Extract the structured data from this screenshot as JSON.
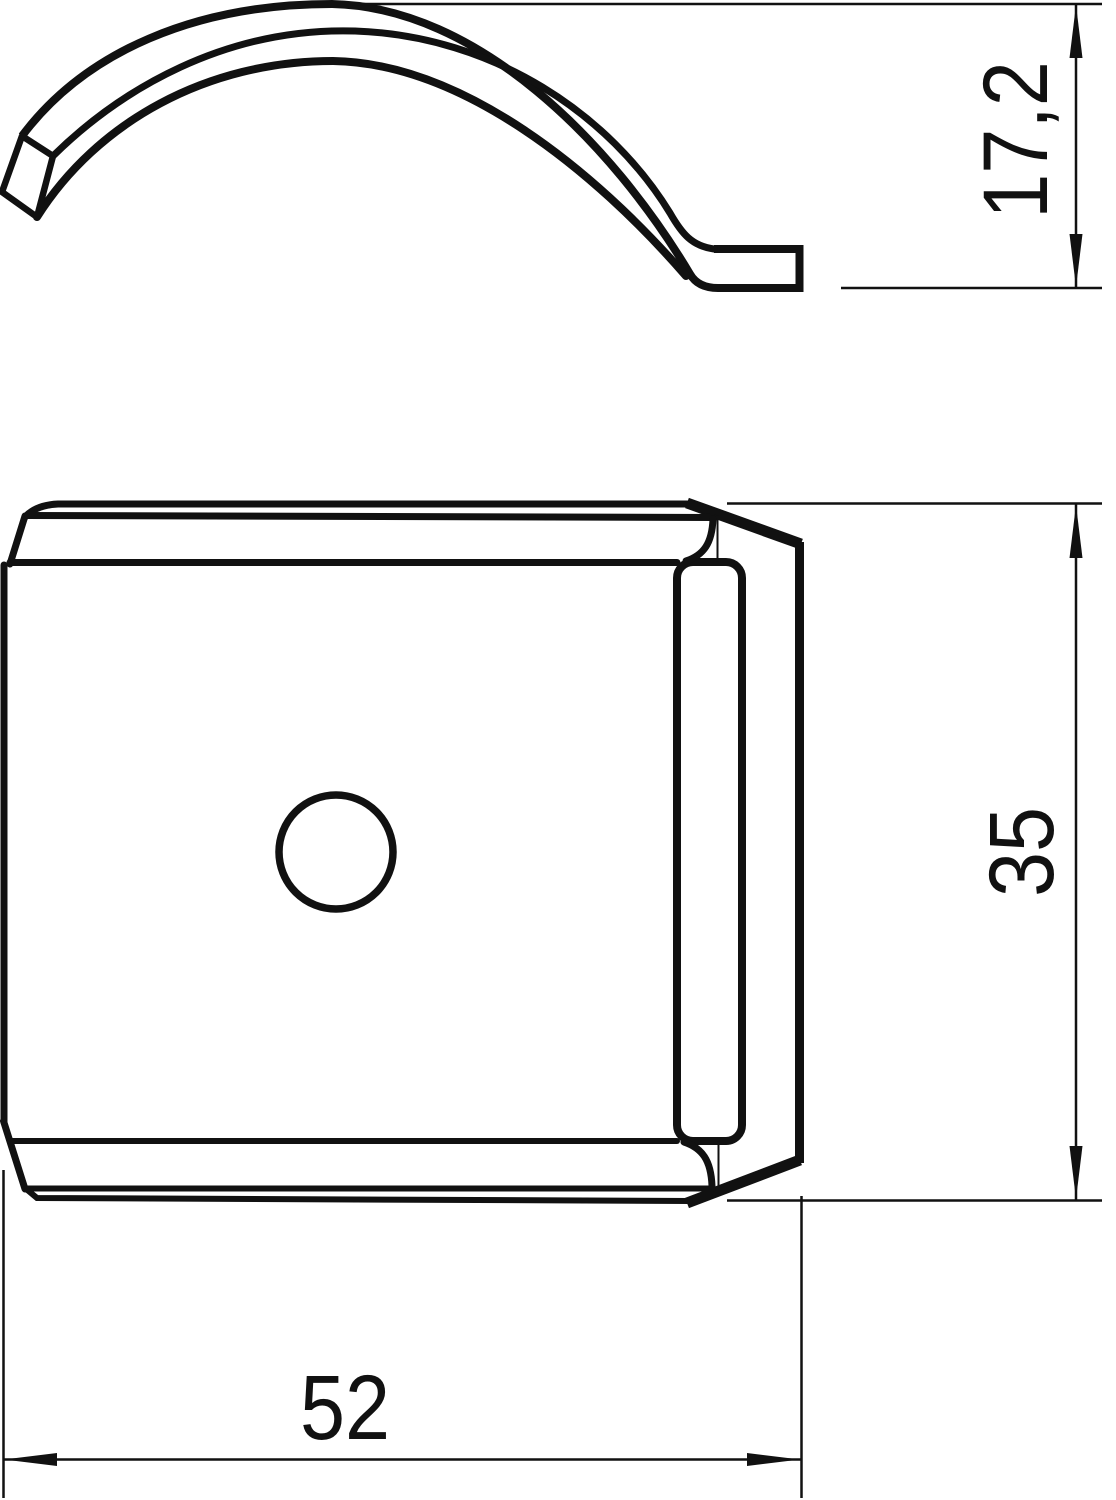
{
  "drawing": {
    "background_color": "#ffffff",
    "line_color": "#111111",
    "dimensions": {
      "profile_height": {
        "value": "17,2",
        "orientation": "vertical"
      },
      "plate_height": {
        "value": "35",
        "orientation": "vertical"
      },
      "plate_width": {
        "value": "52",
        "orientation": "horizontal"
      }
    }
  }
}
